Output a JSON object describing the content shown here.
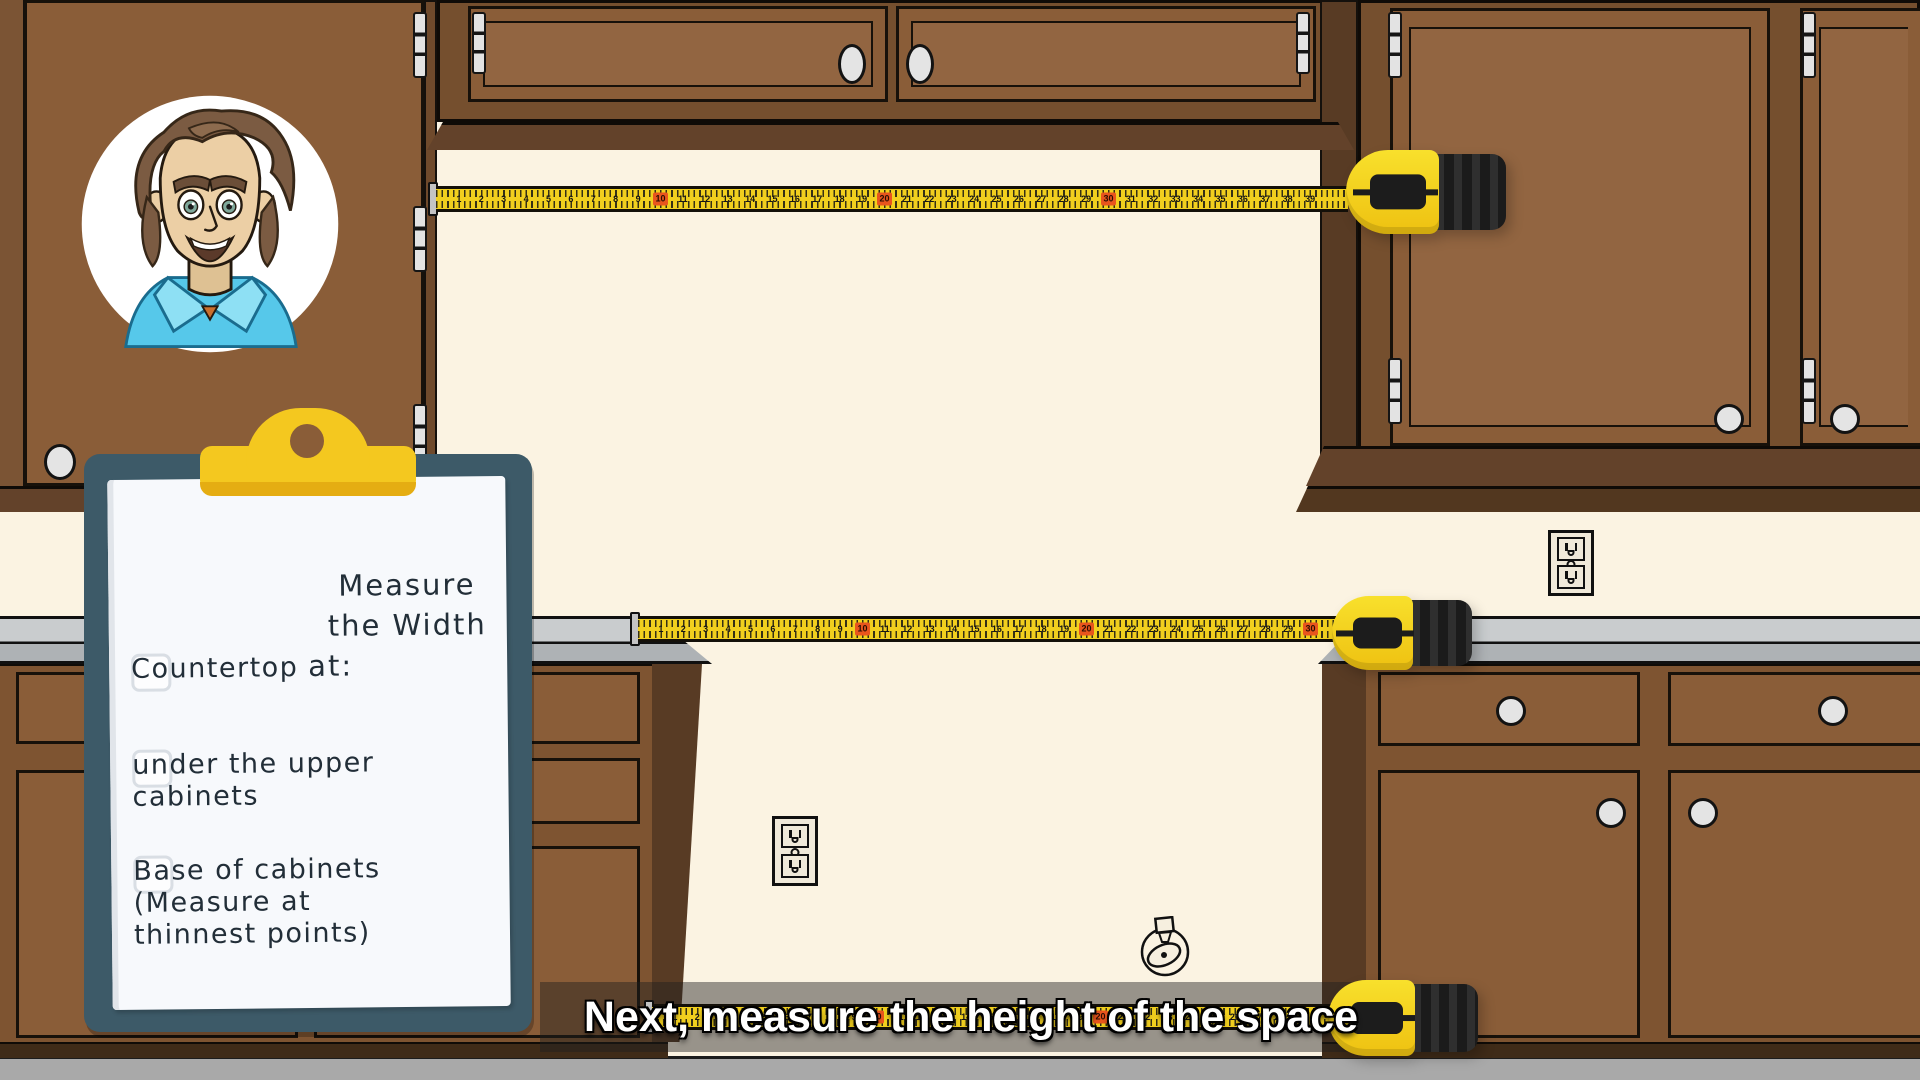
{
  "caption": {
    "text": "Next, measure the height of the space"
  },
  "clipboard": {
    "title_lines": [
      "Measure the Width",
      "at:"
    ],
    "items": [
      {
        "lines": [
          "Countertop"
        ],
        "checked": false
      },
      {
        "lines": [
          "under the upper",
          "cabinets"
        ],
        "checked": false
      },
      {
        "lines": [
          "Base of cabinets",
          "(Measure at",
          "thinnest points)"
        ],
        "checked": false
      }
    ]
  },
  "tapes": [
    {
      "name": "upper-width-tape",
      "start": 1,
      "spacing_px": 22.4,
      "red_every": 10
    },
    {
      "name": "countertop-width-tape",
      "start": 1,
      "spacing_px": 22.4,
      "red_every": 10
    },
    {
      "name": "base-width-tape",
      "start": 1,
      "spacing_px": 22.4,
      "red_every": 10
    }
  ],
  "icons": {
    "presenter": "presenter-avatar",
    "outlet": "power-outlet-icon",
    "valve": "gas-valve-icon",
    "tape_case": "tape-measure-case",
    "clip": "clipboard-clip"
  },
  "colors": {
    "wall": "#fbf3e2",
    "floor": "#a9a9a9",
    "cabinet": "#8a5d38",
    "cabinet_frame": "#754f2e",
    "cabinet_side": "#583b24",
    "cabinet_trim": "#63422a",
    "toe_kick": "#3f2b18",
    "counter_light": "#c9ccce",
    "counter_mid": "#aeb2b5",
    "tape_yellow": "#f1cf1e",
    "tape_red": "#e8551d",
    "case_yellow": "#eec111",
    "case_black": "#232323",
    "board": "#3d5a68",
    "clip": "#f4c81f",
    "paper": "#f7f9fc",
    "ink": "#222e38",
    "caption_bg": "rgba(30,30,30,0.45)"
  }
}
